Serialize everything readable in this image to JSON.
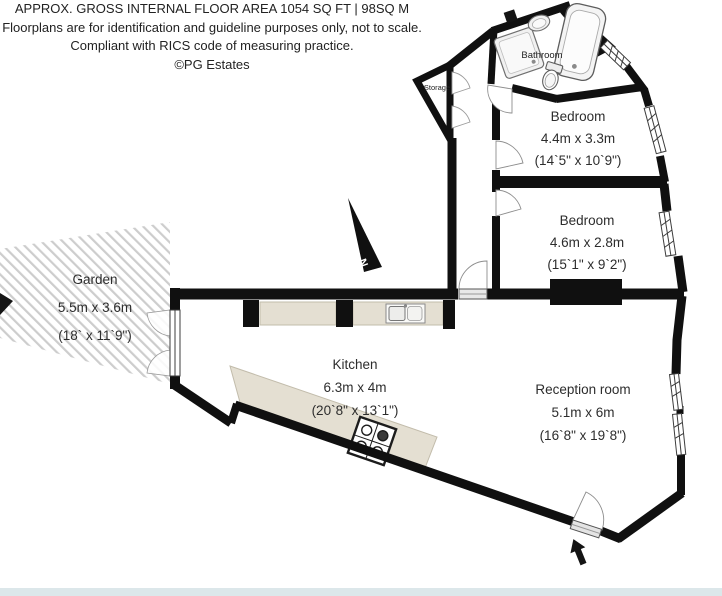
{
  "disclaimer": {
    "line1": "APPROX. GROSS INTERNAL FLOOR AREA 1054 SQ FT | 98SQ M",
    "line2": "Floorplans are for identification and guideline purposes only, not to scale.",
    "line3": "Compliant with RICS code of measuring practice.",
    "line4": "©PG Estates"
  },
  "rooms": {
    "garden": {
      "name": "Garden",
      "metric": "5.5m x 3.6m",
      "imperial": "(18` x 11`9\")"
    },
    "kitchen": {
      "name": "Kitchen",
      "metric": "6.3m x 4m",
      "imperial": "(20`8\" x 13`1\")"
    },
    "reception": {
      "name": "Reception room",
      "metric": "5.1m x 6m",
      "imperial": "(16`8\" x 19`8\")"
    },
    "bedroom_top": {
      "name": "Bedroom",
      "metric": "4.4m x 3.3m",
      "imperial": "(14`5\" x 10`9\")"
    },
    "bedroom_middle": {
      "name": "Bedroom",
      "metric": "4.6m x 2.8m",
      "imperial": "(15`1\" x 9`2\")"
    },
    "bathroom": {
      "name": "Bathroom"
    },
    "storage": {
      "name": "Storage"
    }
  },
  "compass": {
    "label": "N"
  },
  "colors": {
    "wall": "#101010",
    "counter": "#e4dfd2",
    "hatch_line": "#cdcdcd",
    "fixture_fill": "#f4f4f4",
    "footer_bar": "#dce7ea"
  }
}
